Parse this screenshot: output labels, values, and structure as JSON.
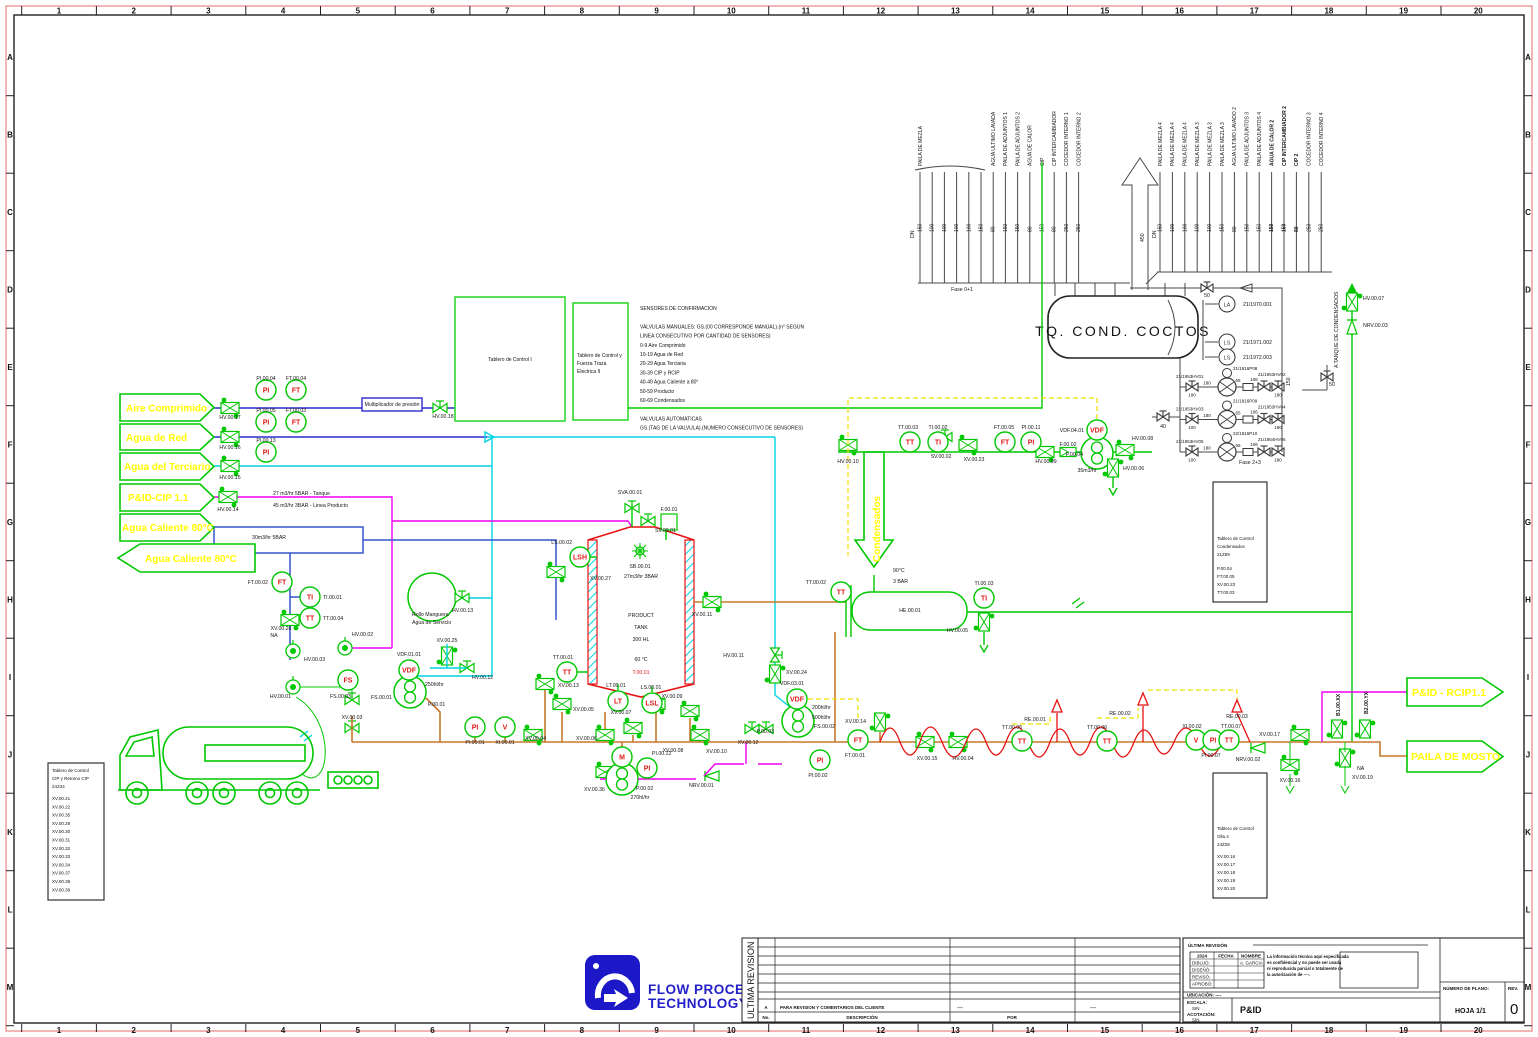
{
  "frame": {
    "cols": [
      "1",
      "2",
      "3",
      "4",
      "5",
      "6",
      "7",
      "8",
      "9",
      "10",
      "11",
      "12",
      "13",
      "14",
      "15",
      "16",
      "17",
      "18",
      "19",
      "20"
    ],
    "rows": [
      "A",
      "B",
      "C",
      "D",
      "E",
      "F",
      "G",
      "H",
      "I",
      "J",
      "K",
      "L",
      "M"
    ]
  },
  "flags": {
    "aire": "Aire Comprimido",
    "agua_red": "Agua de Red",
    "terciario": "Agua del Terciario",
    "cip": "P&ID-CIP 1.1",
    "caliente_in": "Agua Caliente 80°C",
    "caliente_out": "Agua Caliente 80°C",
    "rcip": "P&ID - RCIP1.1",
    "mosto": "PAILA DE MOSTO",
    "condensados": "Condensados"
  },
  "tank": {
    "title": "TQ.  COND.  COCTOS"
  },
  "headers": {
    "dn": "DN",
    "group1": [
      {
        "t": "PAILA DE MEZLA",
        "dn": "150"
      },
      {
        "t": "",
        "dn": "100"
      },
      {
        "t": "",
        "dn": "100"
      },
      {
        "t": "",
        "dn": "100"
      },
      {
        "t": "",
        "dn": "100"
      },
      {
        "t": "",
        "dn": "150"
      },
      {
        "t": "AGUA ULTIMO LAVADA",
        "dn": "80"
      },
      {
        "t": "PAILA DE ADJUNTOS 1",
        "dn": "150"
      },
      {
        "t": "PAILA DE ADJUNTOS 2",
        "dn": "150"
      },
      {
        "t": "AGUA DE CALOR",
        "dn": "80"
      },
      {
        "t": "CIP",
        "dn": "150"
      },
      {
        "t": "CIP INTERCAMBIADOR",
        "dn": "80"
      },
      {
        "t": "COCEDOR INTERNO 1",
        "dn": "250"
      },
      {
        "t": "COCEDOR INTERNO 2",
        "dn": "250"
      }
    ],
    "group2": [
      {
        "t": "PAILA DE MEZLA 4",
        "dn": "150"
      },
      {
        "t": "PAILA DE MEZLA 4",
        "dn": "100"
      },
      {
        "t": "PAILA DE MEZLA 4",
        "dn": "100"
      },
      {
        "t": "PAILA DE MEZLA 3",
        "dn": "100"
      },
      {
        "t": "PAILA DE MEZLA 3",
        "dn": "100"
      },
      {
        "t": "PAILA DE MEZLA 3",
        "dn": "150"
      },
      {
        "t": "AGUA ULTIMO LAVADO 2",
        "dn": "80"
      },
      {
        "t": "PAILA DE ADJUNTOS 3",
        "dn": "150"
      },
      {
        "t": "PAILA DE ADJUNTOS 4",
        "dn": "150"
      },
      {
        "t": "AGUA DE CALOR 2",
        "dn": "150",
        "w": "bold"
      },
      {
        "t": "CIP INTERCAMBIADOR 2",
        "dn": "150",
        "w": "bold"
      },
      {
        "t": "CIP 2",
        "dn": "80",
        "w": "bold"
      },
      {
        "t": "COCEDOR INTERNO 3",
        "dn": "250"
      },
      {
        "t": "COCEDOR INTERNO 4",
        "dn": "250"
      }
    ]
  },
  "pumps": {
    "rows": [
      {
        "left": "21/1953HV01",
        "pump": "21/1816P08",
        "right": "21/1953HV02"
      },
      {
        "left": "21/1953HV03",
        "pump": "21/1816P09",
        "right": "21/1953HV04"
      },
      {
        "left": "21/1953HV05",
        "pump": "22/1816P10",
        "right": "21/1954HV06"
      }
    ],
    "s1": "100",
    "s2": "180",
    "s3": "65",
    "s4": "106",
    "s5": "180"
  },
  "notes": [
    "SENSORES DE CONFIRMACION",
    "",
    "VALVULAS MANUALES: GS.(00 CORRESPONDE MANUAL).(n° SEGUN",
    "LINEA CONSECUTIVO POR CANTIDAD DE SENSORES)",
    "0-9      Aire Comprimido",
    "10-19  Agua de Red",
    "20-29  Agua Terciaria",
    "30-39  CIP y RCIP",
    "40-49  Agua Caliente a 80°",
    "50-59  Producto",
    "60-69  Condensados",
    "",
    "VALVULAS AUTOMATICAS",
    "GS.(TAG DE LA VALVULA).(NUMERO CONSECUTIVO DE SENSORES)"
  ],
  "boards": {
    "control1": "Tablero de Control I",
    "control2": [
      "Tablero de Control y",
      "Fuerza Traza",
      "Electrica II"
    ],
    "cip": {
      "title": [
        "Tablero de Control",
        "CIP y Retorno CIP",
        "24Z34"
      ],
      "items": [
        "XV.00.21",
        "XV.00.22",
        "XV.00.35",
        "XV.00.29",
        "XV.00.30",
        "XV.00.31",
        "XV.00.32",
        "XV.00.33",
        "XV.00.34",
        "XV.00.37",
        "XV.00.38",
        "XV.00.39"
      ]
    },
    "cond": {
      "title": [
        "Tablero de Control",
        "Condensados",
        "21Z89"
      ],
      "items": [
        "P.00.04",
        "FT.00.05",
        "XV.00.23",
        "TT.00.03"
      ]
    },
    "olla": {
      "title": [
        "Tablero de Control",
        "Olla 4",
        "24Z28"
      ],
      "items": [
        "XV.00.16",
        "XV.00.17",
        "XV.00.18",
        "XV.00.19",
        "XV.00.20"
      ]
    }
  },
  "instruments": [
    {
      "x": 266,
      "y": 390,
      "c": "PI",
      "t": "PI.00.04",
      "tx": 266,
      "ty": 380,
      "a": "middle"
    },
    {
      "x": 296,
      "y": 390,
      "c": "FT",
      "t": "FT.00.04",
      "tx": 296,
      "ty": 380,
      "a": "middle"
    },
    {
      "x": 266,
      "y": 422,
      "c": "PI",
      "t": "PI.00.05",
      "tx": 266,
      "ty": 412,
      "a": "middle"
    },
    {
      "x": 296,
      "y": 422,
      "c": "FT",
      "t": "FT.00.03",
      "tx": 296,
      "ty": 412,
      "a": "middle"
    },
    {
      "x": 266,
      "y": 452,
      "c": "PI",
      "t": "PI.00.13",
      "tx": 266,
      "ty": 442,
      "a": "middle"
    },
    {
      "x": 282,
      "y": 582,
      "c": "FT",
      "t": "FT.00.02",
      "tx": 268,
      "ty": 584,
      "a": "end"
    },
    {
      "x": 310,
      "y": 597,
      "c": "TI",
      "t": "TI.00.01",
      "tx": 323,
      "ty": 599,
      "a": "start"
    },
    {
      "x": 310,
      "y": 618,
      "c": "TT",
      "t": "TT.00.04",
      "tx": 323,
      "ty": 620,
      "a": "start"
    },
    {
      "x": 348,
      "y": 680,
      "c": "FS",
      "t": "",
      "cfs": 6
    },
    {
      "x": 409,
      "y": 670,
      "c": "VDF",
      "t": "VDF.01.01",
      "tx": 409,
      "ty": 656,
      "a": "middle",
      "cfs": 5.5
    },
    {
      "x": 475,
      "y": 727,
      "c": "PI",
      "t": "PI.00.01",
      "tx": 475,
      "ty": 744,
      "a": "middle"
    },
    {
      "x": 505,
      "y": 727,
      "c": "V",
      "t": "XI.00.01",
      "tx": 505,
      "ty": 744,
      "a": "middle"
    },
    {
      "x": 580,
      "y": 557,
      "c": "LSH",
      "t": "LS.00.02",
      "tx": 572,
      "ty": 544,
      "a": "end",
      "cfs": 6
    },
    {
      "x": 567,
      "y": 672,
      "c": "TT",
      "t": "TT.00.01",
      "tx": 563,
      "ty": 659,
      "a": "middle"
    },
    {
      "x": 618,
      "y": 701,
      "c": "LT",
      "t": "LT.00.01",
      "tx": 616,
      "ty": 687,
      "a": "middle"
    },
    {
      "x": 652,
      "y": 703,
      "c": "LSL",
      "t": "LS.00.01",
      "tx": 651,
      "ty": 689,
      "a": "middle",
      "cfs": 6
    },
    {
      "x": 622,
      "y": 757,
      "c": "M",
      "t": ""
    },
    {
      "x": 647,
      "y": 768,
      "c": "PI",
      "t": "PI.00.12",
      "tx": 652,
      "ty": 755,
      "a": "start"
    },
    {
      "x": 841,
      "y": 592,
      "c": "TT",
      "t": "TT.00.02",
      "tx": 826,
      "ty": 584,
      "a": "end"
    },
    {
      "x": 984,
      "y": 598,
      "c": "TI",
      "t": "TI.00.03",
      "tx": 984,
      "ty": 585,
      "a": "middle"
    },
    {
      "x": 910,
      "y": 442,
      "c": "TT",
      "t": "TT.00.03",
      "tx": 908,
      "ty": 429,
      "a": "middle"
    },
    {
      "x": 938,
      "y": 442,
      "c": "TI",
      "t": "TI.00.02",
      "tx": 938,
      "ty": 429,
      "a": "middle"
    },
    {
      "x": 1005,
      "y": 442,
      "c": "FT",
      "t": "FT.00.05",
      "tx": 1004,
      "ty": 429,
      "a": "middle"
    },
    {
      "x": 1031,
      "y": 442,
      "c": "PI",
      "t": "PI.00.11",
      "tx": 1031,
      "ty": 429,
      "a": "middle"
    },
    {
      "x": 1097,
      "y": 430,
      "c": "VDF",
      "t": "VDF.04.01",
      "tx": 1084,
      "ty": 432,
      "a": "end",
      "cfs": 5.5
    },
    {
      "x": 858,
      "y": 740,
      "c": "FT",
      "t": "FT.00.01",
      "tx": 855,
      "ty": 757,
      "a": "middle"
    },
    {
      "x": 820,
      "y": 760,
      "c": "PI",
      "t": "PI.00.02",
      "tx": 818,
      "ty": 777,
      "a": "middle"
    },
    {
      "x": 1022,
      "y": 741,
      "c": "TT",
      "t": "TT.00.05",
      "tx": 1012,
      "ty": 729,
      "a": "middle"
    },
    {
      "x": 1107,
      "y": 741,
      "c": "TT",
      "t": "TT.00.06",
      "tx": 1097,
      "ty": 729,
      "a": "middle"
    },
    {
      "x": 1196,
      "y": 740,
      "c": "V",
      "t": "XI.00.02",
      "tx": 1192,
      "ty": 728,
      "a": "middle"
    },
    {
      "x": 1213,
      "y": 740,
      "c": "PI",
      "t": "PI.00.07",
      "tx": 1211,
      "ty": 757,
      "a": "middle"
    },
    {
      "x": 1229,
      "y": 740,
      "c": "TT",
      "t": "TT.00.07",
      "tx": 1231,
      "ty": 728,
      "a": "middle"
    },
    {
      "x": 797,
      "y": 699,
      "c": "VDF",
      "t": "VDF.03.01",
      "tx": 792,
      "ty": 685,
      "a": "middle",
      "cfs": 5.5
    },
    {
      "x": 1227,
      "y": 304,
      "c": "LA",
      "t": "21/1970.001",
      "tx": 1243,
      "ty": 306,
      "a": "start",
      "k": "ib",
      "rad": 8
    },
    {
      "x": 1227,
      "y": 342,
      "c": "LS",
      "t": "21/1971.002",
      "tx": 1243,
      "ty": 344,
      "a": "start",
      "k": "ib",
      "rad": 8
    },
    {
      "x": 1227,
      "y": 357,
      "c": "LS",
      "t": "21/1972.003",
      "tx": 1243,
      "ty": 359,
      "a": "start",
      "k": "ib",
      "rad": 8
    }
  ],
  "labels": [
    {
      "x": 230,
      "y": 419,
      "t": "HV.00.17",
      "a": "middle"
    },
    {
      "x": 230,
      "y": 449,
      "t": "HV.00.16",
      "a": "middle"
    },
    {
      "x": 230,
      "y": 479,
      "t": "HV.00.15",
      "a": "middle"
    },
    {
      "x": 228,
      "y": 511,
      "t": "HV.00.14",
      "a": "middle"
    },
    {
      "x": 443,
      "y": 418,
      "t": "HV.00.18",
      "a": "middle"
    },
    {
      "x": 392,
      "y": 406,
      "t": "Multiplicador de presión",
      "a": "middle",
      "fs": 5.5
    },
    {
      "x": 590,
      "y": 580,
      "t": "XV.00.27",
      "a": "start"
    },
    {
      "x": 281,
      "y": 630,
      "t": "XV.00.26",
      "a": "middle"
    },
    {
      "x": 274,
      "y": 637,
      "t": "NA",
      "a": "middle"
    },
    {
      "x": 304,
      "y": 661,
      "t": "HV.00.03",
      "a": "start"
    },
    {
      "x": 352,
      "y": 636,
      "t": "HV.00.02",
      "a": "start"
    },
    {
      "x": 291,
      "y": 698,
      "t": "HV.00.01",
      "a": "end"
    },
    {
      "x": 330,
      "y": 698,
      "t": "FS.00.03",
      "a": "start"
    },
    {
      "x": 371,
      "y": 699,
      "t": "FS.00.01",
      "a": "start"
    },
    {
      "x": 352,
      "y": 719,
      "t": "XV.00.03",
      "a": "middle"
    },
    {
      "x": 412,
      "y": 616,
      "t": "Rollo Manguera",
      "a": "start"
    },
    {
      "x": 412,
      "y": 624,
      "t": "Agua de Servicio",
      "a": "start"
    },
    {
      "x": 452,
      "y": 612,
      "t": "HV.00.13",
      "a": "start"
    },
    {
      "x": 447,
      "y": 642,
      "t": "XV.00.25",
      "a": "middle"
    },
    {
      "x": 472,
      "y": 679,
      "t": "HV.00.12",
      "a": "start"
    },
    {
      "x": 425,
      "y": 686,
      "t": "250hl/hr",
      "a": "start",
      "fs": 8.5
    },
    {
      "x": 428,
      "y": 706,
      "t": "P.00.01",
      "a": "start"
    },
    {
      "x": 558,
      "y": 687,
      "t": "XV.00.13",
      "a": "start"
    },
    {
      "x": 573,
      "y": 711,
      "t": "XV.00.05",
      "a": "start"
    },
    {
      "x": 546,
      "y": 740,
      "t": "XV.00.04",
      "a": "end"
    },
    {
      "x": 576,
      "y": 740,
      "t": "XV.00.06",
      "a": "start"
    },
    {
      "x": 621,
      "y": 714,
      "t": "XV.00.07",
      "a": "middle"
    },
    {
      "x": 673,
      "y": 752,
      "t": "XV.00.08",
      "a": "middle"
    },
    {
      "x": 672,
      "y": 698,
      "t": "XV.00.09",
      "a": "middle"
    },
    {
      "x": 706,
      "y": 753,
      "t": "XV.00.10",
      "a": "start"
    },
    {
      "x": 584,
      "y": 791,
      "t": "XV.00.36",
      "a": "start"
    },
    {
      "x": 689,
      "y": 787,
      "t": "NRV.00.01",
      "a": "start"
    },
    {
      "x": 636,
      "y": 790,
      "t": "P.00.02",
      "a": "start"
    },
    {
      "x": 640,
      "y": 799,
      "t": "270hl/hr",
      "a": "middle",
      "fs": 8.5
    },
    {
      "x": 748,
      "y": 744,
      "t": "XV.00.12",
      "a": "middle"
    },
    {
      "x": 744,
      "y": 657,
      "t": "HV.00.11",
      "a": "end"
    },
    {
      "x": 786,
      "y": 674,
      "t": "XV.00.24",
      "a": "start"
    },
    {
      "x": 812,
      "y": 709,
      "t": "200hl/hr",
      "a": "start",
      "fs": 8.5
    },
    {
      "x": 812,
      "y": 719,
      "t": "500hl/hr",
      "a": "start",
      "fs": 8.5
    },
    {
      "x": 774,
      "y": 733,
      "t": "P.00.03",
      "a": "end"
    },
    {
      "x": 814,
      "y": 728,
      "t": "FS.00.02",
      "a": "start"
    },
    {
      "x": 866,
      "y": 723,
      "t": "XV.00.14",
      "a": "end"
    },
    {
      "x": 927,
      "y": 760,
      "t": "XV.00.15",
      "a": "middle"
    },
    {
      "x": 963,
      "y": 760,
      "t": "HV.00.04",
      "a": "middle"
    },
    {
      "x": 848,
      "y": 463,
      "t": "HV.00.10",
      "a": "middle"
    },
    {
      "x": 941,
      "y": 458,
      "t": "SV.00.02",
      "a": "middle"
    },
    {
      "x": 974,
      "y": 461,
      "t": "XV.00.23",
      "a": "middle"
    },
    {
      "x": 1046,
      "y": 463,
      "t": "HV.00.09",
      "a": "middle"
    },
    {
      "x": 1068,
      "y": 446,
      "t": "F.00.02",
      "a": "middle"
    },
    {
      "x": 1083,
      "y": 456,
      "t": "P.00.04",
      "a": "end"
    },
    {
      "x": 1087,
      "y": 472,
      "t": "35m3/hr",
      "a": "middle",
      "fs": 8.5
    },
    {
      "x": 1132,
      "y": 440,
      "t": "HV.00.08",
      "a": "start"
    },
    {
      "x": 1123,
      "y": 470,
      "t": "HV.00.06",
      "a": "start"
    },
    {
      "x": 910,
      "y": 612,
      "t": "HE.00.01",
      "a": "middle"
    },
    {
      "x": 968,
      "y": 632,
      "t": "HV.00.05",
      "a": "end"
    },
    {
      "x": 893,
      "y": 572,
      "t": "90°C",
      "a": "start",
      "fs": 8.5
    },
    {
      "x": 893,
      "y": 583,
      "t": "3 BAR",
      "a": "start",
      "fs": 8.5
    },
    {
      "x": 630,
      "y": 494,
      "t": "SVA.00.01",
      "a": "middle"
    },
    {
      "x": 655,
      "y": 532,
      "t": "SV.00.01",
      "a": "start"
    },
    {
      "x": 669,
      "y": 511,
      "t": "F.00.01",
      "a": "middle"
    },
    {
      "x": 640,
      "y": 568,
      "t": "SB.00.01",
      "a": "middle"
    },
    {
      "x": 641,
      "y": 578,
      "t": "27m3/hr 3BAR",
      "a": "middle",
      "fs": 8.5
    },
    {
      "x": 641,
      "y": 617,
      "t": "PRODUCT",
      "a": "middle",
      "fs": 9
    },
    {
      "x": 641,
      "y": 629,
      "t": "TANK",
      "a": "middle",
      "fs": 9
    },
    {
      "x": 641,
      "y": 641,
      "t": "300 HL",
      "a": "middle",
      "fs": 9
    },
    {
      "x": 641,
      "y": 661,
      "t": "60 °C",
      "a": "middle",
      "fs": 8.5
    },
    {
      "x": 641,
      "y": 674,
      "t": "T.00.01",
      "a": "middle",
      "fs": 8.5,
      "cl": "red"
    },
    {
      "x": 702,
      "y": 616,
      "t": "XV.00.11",
      "a": "middle"
    },
    {
      "x": 1035,
      "y": 721,
      "t": "RE.00.01",
      "a": "middle"
    },
    {
      "x": 1120,
      "y": 715,
      "t": "RE.00.02",
      "a": "middle"
    },
    {
      "x": 1237,
      "y": 718,
      "t": "RE.00.03",
      "a": "middle"
    },
    {
      "x": 1248,
      "y": 761,
      "t": "NRV.00.02",
      "a": "middle"
    },
    {
      "x": 1280,
      "y": 736,
      "t": "XV.00.17",
      "a": "end"
    },
    {
      "x": 1290,
      "y": 782,
      "t": "XV.00.16",
      "a": "middle"
    },
    {
      "x": 1357,
      "y": 770,
      "t": "NA",
      "a": "start"
    },
    {
      "x": 1352,
      "y": 779,
      "t": "XV.00.19",
      "a": "start"
    },
    {
      "x": 1340,
      "y": 716,
      "t": "B1.00.XX",
      "a": "start",
      "r": -90,
      "fs": 4.5,
      "w": "bold"
    },
    {
      "x": 1368,
      "y": 714,
      "t": "B2.00.YX",
      "a": "start",
      "r": -90,
      "fs": 4.5,
      "w": "bold"
    },
    {
      "x": 1363,
      "y": 300,
      "t": "HV.00.07",
      "a": "start"
    },
    {
      "x": 1363,
      "y": 327,
      "t": "NRV.00.03",
      "a": "start"
    },
    {
      "x": 1163,
      "y": 428,
      "t": "40",
      "a": "middle"
    },
    {
      "x": 1207,
      "y": 297,
      "t": "50",
      "a": "middle"
    },
    {
      "x": 1332,
      "y": 386,
      "t": "50",
      "a": "middle"
    },
    {
      "x": 962,
      "y": 291,
      "t": "Fase 0+1",
      "a": "middle"
    },
    {
      "x": 1250,
      "y": 464,
      "t": "Fase 2+3",
      "a": "middle"
    },
    {
      "x": 1144,
      "y": 242,
      "t": "450",
      "a": "start",
      "r": -90
    },
    {
      "x": 1290,
      "y": 386,
      "t": "150",
      "a": "start",
      "r": -90
    },
    {
      "x": 1338,
      "y": 368,
      "t": "A TANQUE DE CONDENSADOS",
      "a": "start",
      "r": -90
    },
    {
      "x": 914,
      "y": 238,
      "t": "DN",
      "a": "start",
      "r": -90
    },
    {
      "x": 1156,
      "y": 238,
      "t": "DN",
      "a": "start",
      "r": -90
    },
    {
      "x": 273,
      "y": 495,
      "t": "27 m3/hr 5BAR - Tanque",
      "a": "start",
      "fs": 8.5
    },
    {
      "x": 273,
      "y": 507,
      "t": "45 m3/hr 3BAR - Linea Producto",
      "a": "start",
      "fs": 8.5
    },
    {
      "x": 252,
      "y": 539,
      "t": "30m3/hr 5BAR",
      "a": "start",
      "fs": 8.5
    }
  ],
  "logo": {
    "l1": "FLOW PROCESS",
    "l2": "TECHNOLOGY"
  },
  "revision": {
    "vertical": "ULTIMA REVISION",
    "row_no": "A",
    "row_desc": "PARA  REVISION  Y  COMENTARIOS  DEL  CLIENTE",
    "row_por": "----",
    "row_rev": "----",
    "h_no": "No.",
    "h_desc": "DESCRIPCIÓN",
    "h_por": "POR"
  },
  "titleblock": {
    "ultima": "ÚLTIMA REVISIÓN",
    "year": "2024",
    "fecha": "FECHA",
    "nombre": "NOMBRE",
    "dibujo": "DIBUJÓ:",
    "dibujo_nombre": "A. GARCIA",
    "diseno": "DISEÑÓ:",
    "reviso": "REVISÓ:",
    "aprobo": "APROBÓ:",
    "conf": [
      "La información técnica aquí especificada",
      "es confidencial y no puede ser usada",
      "ni reproducida parcial o totalmente de",
      "la autorización de ----."
    ],
    "ubicacion": "UBICACIÓN: ----",
    "escala_l": "ESCALA:",
    "escala_v": "SIN",
    "acot_l": "ACOTACIÓN:",
    "acot_v": "SIN",
    "doc": "P&ID",
    "plano_l": "NÚMERO DE PLANO:",
    "hoja": "HOJA  1/1",
    "rev_l": "REV.",
    "rev_v": "0"
  },
  "colors": {
    "green": "#00c800",
    "yellow": "#ffff00",
    "magenta": "#f000f0",
    "cyan": "#00d4e4",
    "navy": "#2a2ad0",
    "orange": "#c8782d",
    "red": "#e81010",
    "pink": "#f0a2a2",
    "blue_logo": "#1c18c8"
  }
}
